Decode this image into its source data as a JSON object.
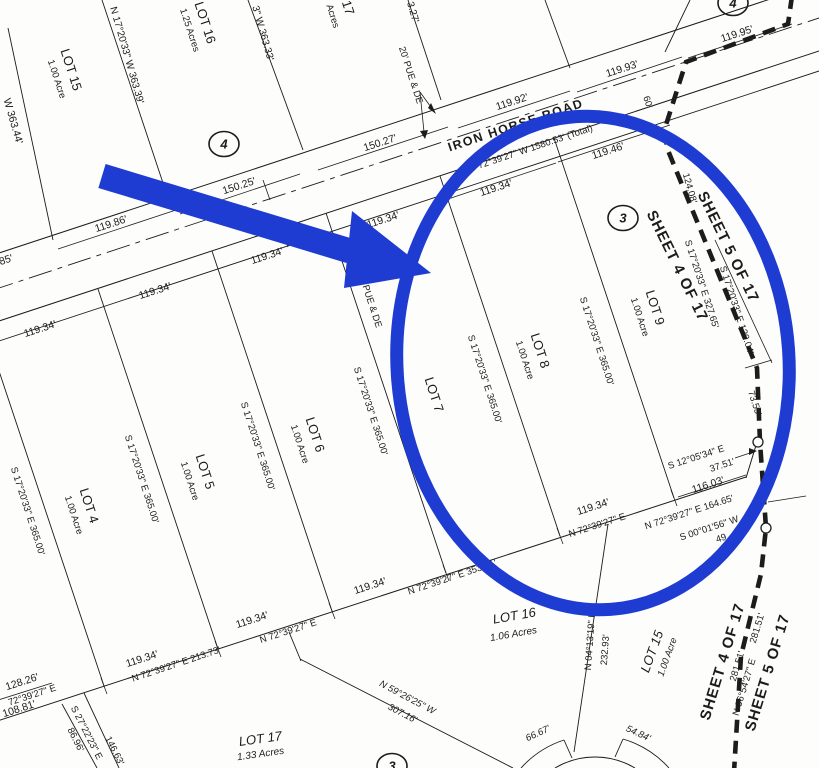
{
  "document": {
    "type": "subdivision-plat-sheet",
    "road_name": "IRON  HORSE  ROAD",
    "road_bearing": "S 72°39'27\" W  1580.53'  (Total)",
    "sheet_references": [
      "SHEET 5 OF 17",
      "SHEET 4 OF 17"
    ]
  },
  "colors": {
    "ink": "#1c1c1c",
    "paper": "#fdfdfc",
    "highlight": "#1e3bd2"
  },
  "circled_markers": [
    {
      "id": "block-marker-4-left",
      "n": "4",
      "x": 224,
      "y": 144
    },
    {
      "id": "block-marker-4-topright",
      "n": "4",
      "x": 733,
      "y": 3
    },
    {
      "id": "block-marker-3-right",
      "n": "3",
      "x": 623,
      "y": 218
    },
    {
      "id": "block-marker-3-bottom",
      "n": "3",
      "x": 392,
      "y": 766
    }
  ],
  "labels": [
    {
      "id": "dim-363-44",
      "text": "W  363.44'",
      "x": 10,
      "y": 122,
      "rot": 74,
      "size": 10.5
    },
    {
      "id": "lot15-north-name",
      "text": "LOT 15",
      "x": 67,
      "y": 71,
      "rot": 72,
      "size": 13
    },
    {
      "id": "lot15-north-area",
      "text": "1.00 Acre",
      "x": 54,
      "y": 80,
      "rot": 72,
      "size": 9.5
    },
    {
      "id": "bearing-363-39",
      "text": "N 17°20'33\" W  363.39'",
      "x": 124,
      "y": 56,
      "rot": 74,
      "size": 10
    },
    {
      "id": "lot16-north-name",
      "text": "LOT 16",
      "x": 201,
      "y": 24,
      "rot": 72,
      "size": 13
    },
    {
      "id": "lot16-north-area",
      "text": "1.25 Acres",
      "x": 187,
      "y": 31,
      "rot": 72,
      "size": 9.5
    },
    {
      "id": "bearing-363-33",
      "text": "3\" W  363.33'",
      "x": 260,
      "y": 34,
      "rot": 74,
      "size": 10
    },
    {
      "id": "lot17-north-name-partial",
      "text": "17",
      "x": 344,
      "y": 9,
      "rot": 72,
      "size": 13
    },
    {
      "id": "lot17-north-area-partial",
      "text": "Acres",
      "x": 330,
      "y": 17,
      "rot": 72,
      "size": 9.5
    },
    {
      "id": "dim-3-27",
      "text": "3.27'",
      "x": 410,
      "y": 13,
      "rot": 74,
      "size": 10
    },
    {
      "id": "pue-de-north",
      "text": "20'  PUE  &  DE",
      "x": 408,
      "y": 76,
      "rot": 72,
      "size": 9.5
    },
    {
      "id": "dim-150-27",
      "text": "150.27'",
      "x": 381,
      "y": 146,
      "rot": -18,
      "size": 10.5
    },
    {
      "id": "dim-150-25",
      "text": "150.25'",
      "x": 240,
      "y": 189,
      "rot": -18,
      "size": 10.5
    },
    {
      "id": "dim-119-86",
      "text": "119.86'",
      "x": 112,
      "y": 227,
      "rot": -18,
      "size": 10.5
    },
    {
      "id": "dim-85-partial",
      "text": "85'",
      "x": 7,
      "y": 263,
      "rot": -18,
      "size": 10.5
    },
    {
      "id": "dim-119-92",
      "text": "119.92'",
      "x": 513,
      "y": 105,
      "rot": -18,
      "size": 10.5
    },
    {
      "id": "dim-119-93",
      "text": "119.93'",
      "x": 623,
      "y": 72,
      "rot": -18,
      "size": 10.5
    },
    {
      "id": "dim-119-95",
      "text": "119.95'",
      "x": 738,
      "y": 37,
      "rot": -18,
      "size": 10.5
    },
    {
      "id": "road-name",
      "text": "IRON  HORSE  ROAD",
      "x": 517,
      "y": 129,
      "rot": -18.5,
      "size": 12.5,
      "bold": true,
      "ls": 1.5
    },
    {
      "id": "road-bearing",
      "text": "S 72°39'27\" W  1580.53'  (Total)",
      "x": 532,
      "y": 151,
      "rot": -18.5,
      "size": 9.5
    },
    {
      "id": "dim-60",
      "text": "60'",
      "x": 645,
      "y": 103,
      "rot": 72,
      "size": 9.5
    },
    {
      "id": "dim-119-46",
      "text": "119.46'",
      "x": 609,
      "y": 154,
      "rot": -18,
      "size": 10.5
    },
    {
      "id": "dim-119-34-lot8",
      "text": "119.34'",
      "x": 497,
      "y": 191,
      "rot": -18,
      "size": 10.5
    },
    {
      "id": "dim-124-08",
      "text": "124.08'",
      "x": 687,
      "y": 189,
      "rot": 74,
      "size": 9.5
    },
    {
      "id": "sheet5-of-17-top",
      "text": "SHEET 5 OF 17",
      "x": 724,
      "y": 249,
      "rot": 64,
      "size": 15,
      "bold": true,
      "ls": 1
    },
    {
      "id": "sheet4-of-17-top",
      "text": "SHEET 4 OF 17",
      "x": 673,
      "y": 268,
      "rot": 64,
      "size": 15,
      "bold": true,
      "ls": 1
    },
    {
      "id": "bearing-327-65",
      "text": "S 17°20'33\" E  327.65'",
      "x": 699,
      "y": 285,
      "rot": 72,
      "size": 9.5
    },
    {
      "id": "bearing-130-04",
      "text": "S 17°20'33\" E  130.04'",
      "x": 734,
      "y": 311,
      "rot": 72,
      "size": 9.5
    },
    {
      "id": "dim-73-53",
      "text": "73.53'",
      "x": 752,
      "y": 404,
      "rot": 72,
      "size": 9.5
    },
    {
      "id": "lot9-name",
      "text": "LOT 9",
      "x": 651,
      "y": 309,
      "rot": 72,
      "size": 13
    },
    {
      "id": "lot9-area",
      "text": "1.00 Acre",
      "x": 637,
      "y": 318,
      "rot": 72,
      "size": 9.5
    },
    {
      "id": "bearing-lot8-9",
      "text": "S 17°20'33\" E  365.00'",
      "x": 594,
      "y": 342,
      "rot": 72,
      "size": 9.5
    },
    {
      "id": "lot8-name",
      "text": "LOT 8",
      "x": 536,
      "y": 352,
      "rot": 72,
      "size": 13
    },
    {
      "id": "lot8-area",
      "text": "1.00 Acre",
      "x": 522,
      "y": 361,
      "rot": 72,
      "size": 9.5
    },
    {
      "id": "bearing-lot7-8",
      "text": "S 17°20'33\" E  365.00'",
      "x": 482,
      "y": 380,
      "rot": 72,
      "size": 9.5
    },
    {
      "id": "lot7-name",
      "text": "LOT 7",
      "x": 430,
      "y": 396,
      "rot": 72,
      "size": 13
    },
    {
      "id": "pue-de-south",
      "text": "20'  PUE  &  DE",
      "x": 367,
      "y": 300,
      "rot": 72,
      "size": 9.5
    },
    {
      "id": "bearing-lot6-7",
      "text": "S 17°20'33\" E  365.00'",
      "x": 368,
      "y": 412,
      "rot": 72,
      "size": 9.5
    },
    {
      "id": "lot6-name",
      "text": "LOT 6",
      "x": 311,
      "y": 436,
      "rot": 72,
      "size": 13
    },
    {
      "id": "lot6-area",
      "text": "1.00 Acre",
      "x": 297,
      "y": 445,
      "rot": 72,
      "size": 9.5
    },
    {
      "id": "bearing-lot5-6",
      "text": "S 17°20'33\" E  365.00'",
      "x": 255,
      "y": 447,
      "rot": 72,
      "size": 9.5
    },
    {
      "id": "lot5-name",
      "text": "LOT 5",
      "x": 201,
      "y": 473,
      "rot": 72,
      "size": 13
    },
    {
      "id": "lot5-area",
      "text": "1.00 Acre",
      "x": 187,
      "y": 482,
      "rot": 72,
      "size": 9.5
    },
    {
      "id": "bearing-lot4-5",
      "text": "S 17°20'33\" E  365.00'",
      "x": 139,
      "y": 480,
      "rot": 72,
      "size": 9.5
    },
    {
      "id": "lot4-name",
      "text": "LOT 4",
      "x": 85,
      "y": 507,
      "rot": 72,
      "size": 13
    },
    {
      "id": "lot4-area",
      "text": "1.00 Acre",
      "x": 71,
      "y": 516,
      "rot": 72,
      "size": 9.5
    },
    {
      "id": "bearing-lot3-4",
      "text": "S 17°20'33\" E  365.00'",
      "x": 25,
      "y": 512,
      "rot": 72,
      "size": 9.5
    },
    {
      "id": "dim-119-34-front56",
      "text": "119.34'",
      "x": 268,
      "y": 259,
      "rot": -18,
      "size": 10.5
    },
    {
      "id": "dim-119-34-front45",
      "text": "119.34'",
      "x": 156,
      "y": 294,
      "rot": -18,
      "size": 10.5
    },
    {
      "id": "dim-119-34-front34",
      "text": "119.34'",
      "x": 41,
      "y": 332,
      "rot": -18,
      "size": 10.5
    },
    {
      "id": "dim-119-34-front67",
      "text": "119.34'",
      "x": 384,
      "y": 223,
      "rot": -18,
      "size": 10.5
    },
    {
      "id": "dim-119-34-rear78",
      "text": "119.34'",
      "x": 594,
      "y": 510,
      "rot": -18,
      "size": 10.5
    },
    {
      "id": "bearing-rear78",
      "text": "N 72°39'27\" E",
      "x": 598,
      "y": 528,
      "rot": -18,
      "size": 9.5
    },
    {
      "id": "dim-116-03",
      "text": "116.03'",
      "x": 709,
      "y": 488,
      "rot": -18,
      "size": 10.5
    },
    {
      "id": "bearing-164-65",
      "text": "N 72°39'27\" E  164.65'",
      "x": 690,
      "y": 515,
      "rot": -18,
      "size": 9.5
    },
    {
      "id": "bearing-s12-05-34",
      "text": "S 12°05'34\" E",
      "x": 697,
      "y": 460,
      "rot": -18,
      "size": 9.5
    },
    {
      "id": "dim-37-51",
      "text": "37.51'",
      "x": 723,
      "y": 468,
      "rot": -18,
      "size": 9.5
    },
    {
      "id": "bearing-s00-01-56",
      "text": "S 00°01'56\" W",
      "x": 710,
      "y": 531,
      "rot": -18,
      "size": 9.5
    },
    {
      "id": "dim-49-partial",
      "text": "49",
      "x": 722,
      "y": 541,
      "rot": -18,
      "size": 9.5
    },
    {
      "id": "dim-119-34-rear67",
      "text": "119.34'",
      "x": 371,
      "y": 589,
      "rot": -18,
      "size": 10.5
    },
    {
      "id": "bearing-353-81",
      "text": "N 72°39'27\" E  353.81'",
      "x": 453,
      "y": 580,
      "rot": -18.5,
      "size": 9.5
    },
    {
      "id": "dim-119-34-rear56",
      "text": "119.34'",
      "x": 253,
      "y": 623,
      "rot": -18,
      "size": 10.5
    },
    {
      "id": "bearing-rear56",
      "text": "N 72°39'27\" E",
      "x": 289,
      "y": 634,
      "rot": -18,
      "size": 9.5
    },
    {
      "id": "dim-119-34-rear45",
      "text": "119.34'",
      "x": 143,
      "y": 662,
      "rot": -18,
      "size": 10.5
    },
    {
      "id": "bearing-213-73",
      "text": "N 72°39'27\" E  213.73'",
      "x": 177,
      "y": 667,
      "rot": -18.5,
      "size": 9.5
    },
    {
      "id": "dim-128-26",
      "text": "128.26'",
      "x": 23,
      "y": 685,
      "rot": -18,
      "size": 10.5
    },
    {
      "id": "bearing-72-39-27-partial",
      "text": "72°39'27\" E",
      "x": 33,
      "y": 698,
      "rot": -18,
      "size": 9.5
    },
    {
      "id": "dim-108-81",
      "text": "108.81'",
      "x": 20,
      "y": 712,
      "rot": -18,
      "size": 10.5
    },
    {
      "id": "bearing-s27-22-23",
      "text": "S 27°22'23\" E",
      "x": 84,
      "y": 734,
      "rot": 63,
      "size": 9.5
    },
    {
      "id": "dim-86-96",
      "text": "86.96'",
      "x": 73,
      "y": 741,
      "rot": 63,
      "size": 9.5
    },
    {
      "id": "dim-146-63",
      "text": "146.63'",
      "x": 112,
      "y": 752,
      "rot": 63,
      "size": 9.5
    },
    {
      "id": "lot16-south-name",
      "text": "LOT  16",
      "x": 515,
      "y": 620,
      "rot": -10,
      "size": 13,
      "it": true
    },
    {
      "id": "lot16-south-area",
      "text": "1.06 Acres",
      "x": 514,
      "y": 637,
      "rot": -10,
      "size": 10,
      "it": true
    },
    {
      "id": "bearing-n04-13-19",
      "text": "N 04°13'19\" E",
      "x": 593,
      "y": 641,
      "rot": -86,
      "size": 9.5
    },
    {
      "id": "dim-232-93",
      "text": "232.93'",
      "x": 608,
      "y": 650,
      "rot": -86,
      "size": 9.5
    },
    {
      "id": "lot15-south-name",
      "text": "LOT 15",
      "x": 656,
      "y": 653,
      "rot": -70,
      "size": 13,
      "it": true
    },
    {
      "id": "lot15-south-area",
      "text": "1.00 Acre",
      "x": 670,
      "y": 658,
      "rot": -70,
      "size": 9.5,
      "it": true
    },
    {
      "id": "lot17-south-name",
      "text": "LOT  17",
      "x": 261,
      "y": 743,
      "rot": -8,
      "size": 13,
      "it": true
    },
    {
      "id": "lot17-south-area",
      "text": "1.33 Acres",
      "x": 261,
      "y": 757,
      "rot": -8,
      "size": 10,
      "it": true
    },
    {
      "id": "bearing-n59-26-25",
      "text": "N 59°26'25\" W",
      "x": 406,
      "y": 700,
      "rot": 28,
      "size": 9.5,
      "it": true
    },
    {
      "id": "dim-307-16",
      "text": "307.16'",
      "x": 401,
      "y": 716,
      "rot": 28,
      "size": 9.5,
      "it": true
    },
    {
      "id": "dim-66-67",
      "text": "66.67'",
      "x": 539,
      "y": 736,
      "rot": -25,
      "size": 9.5,
      "it": true
    },
    {
      "id": "dim-54-84",
      "text": "54.84'",
      "x": 637,
      "y": 736,
      "rot": 25,
      "size": 9.5,
      "it": true
    },
    {
      "id": "sheet4-of-17-bottom",
      "text": "SHEET 4 OF 17",
      "x": 727,
      "y": 663,
      "rot": -73,
      "size": 15,
      "bold": true,
      "ls": 1
    },
    {
      "id": "sheet5-of-17-bottom",
      "text": "SHEET 5 OF 17",
      "x": 772,
      "y": 674,
      "rot": -73,
      "size": 15,
      "bold": true,
      "ls": 1
    },
    {
      "id": "dim-281-51-right",
      "text": "281.51'",
      "x": 760,
      "y": 629,
      "rot": -73,
      "size": 9.5
    },
    {
      "id": "bearing-n06-54-27",
      "text": "N 06°54'27\" E",
      "x": 747,
      "y": 688,
      "rot": -73,
      "size": 9.5
    },
    {
      "id": "dim-281-51-left",
      "text": "281.51'",
      "x": 740,
      "y": 667,
      "rot": -73,
      "size": 9.5
    }
  ],
  "annotation": {
    "shape": "hand-drawn emphasis circle with arrow",
    "target": "Lots 7, 8 and 9 on Iron Horse Road"
  }
}
